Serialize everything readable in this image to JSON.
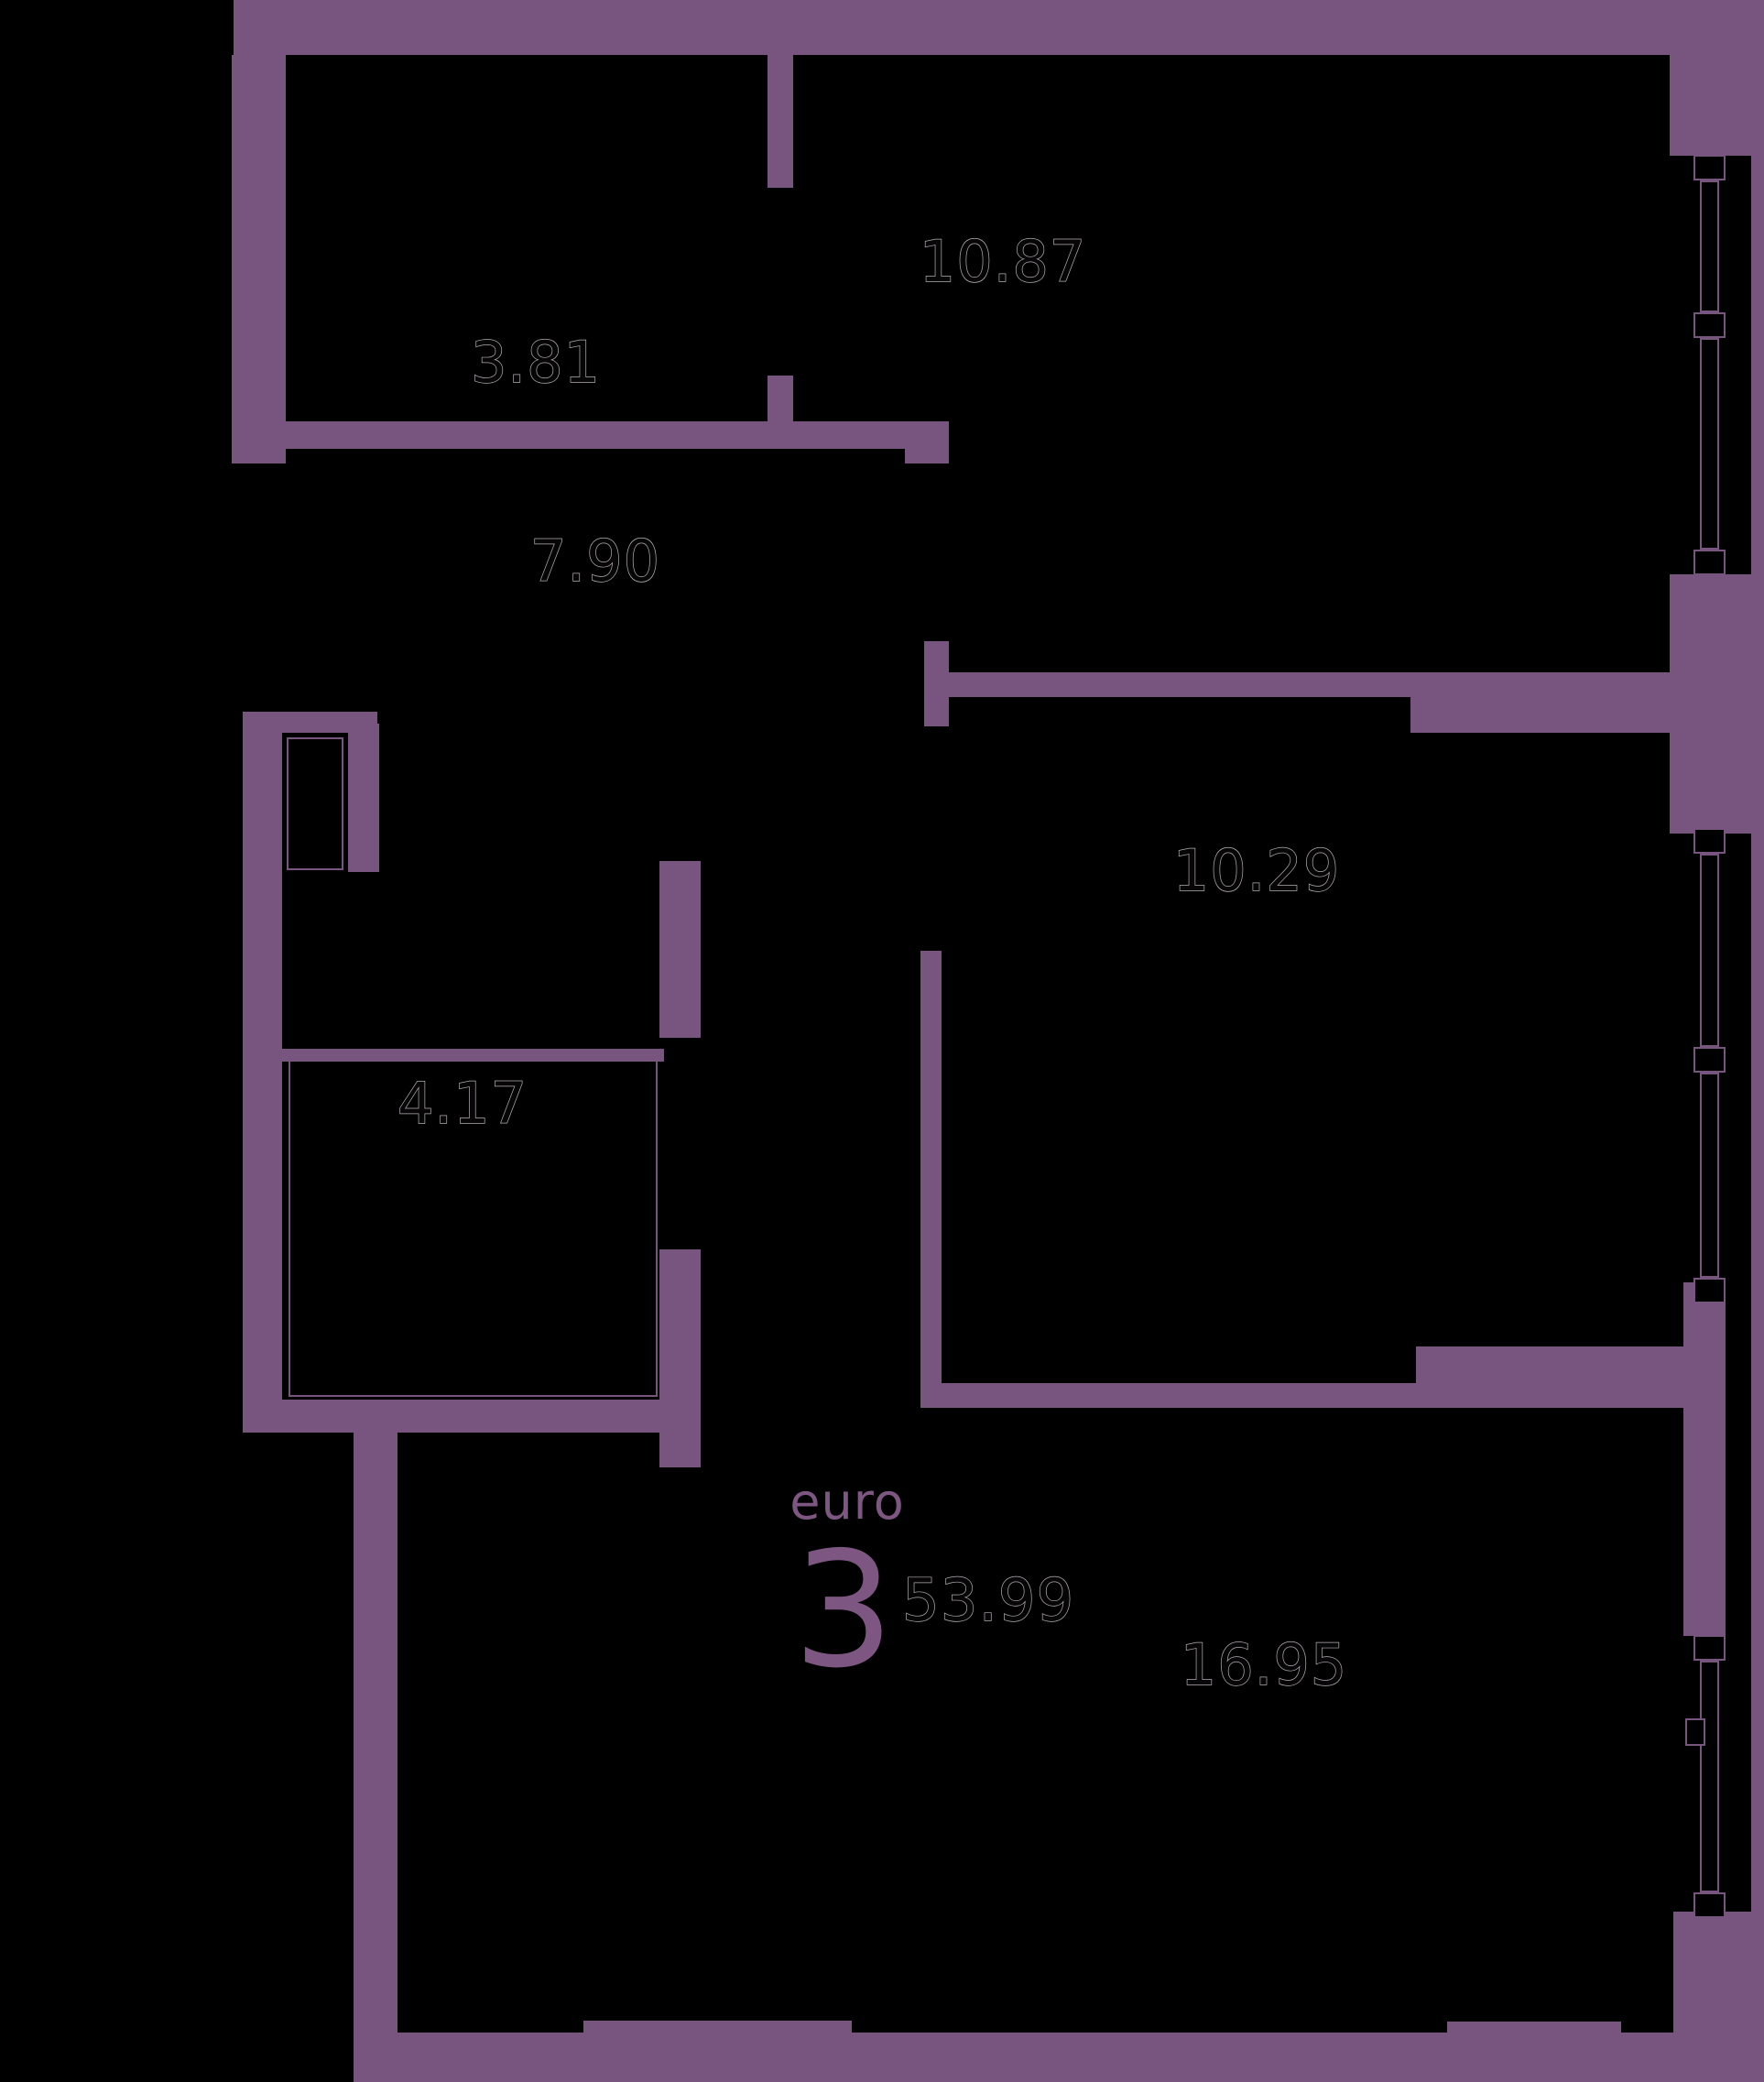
{
  "title": {
    "type_label": "euro",
    "rooms_count": "3",
    "total_area": "53.99"
  },
  "rooms": [
    {
      "id": "wardrobe",
      "area": "3.81"
    },
    {
      "id": "bedroom-top",
      "area": "10.87"
    },
    {
      "id": "hall-corridor",
      "area": "7.90"
    },
    {
      "id": "bedroom-middle",
      "area": "10.29"
    },
    {
      "id": "bathroom",
      "area": "4.17"
    },
    {
      "id": "living-kitchen",
      "area": "16.95"
    }
  ],
  "colors": {
    "background": "#000000",
    "wall": "#78557E",
    "title_text": "#7D5782",
    "label_fill": "#060606",
    "label_outline": "#b4acb4"
  }
}
